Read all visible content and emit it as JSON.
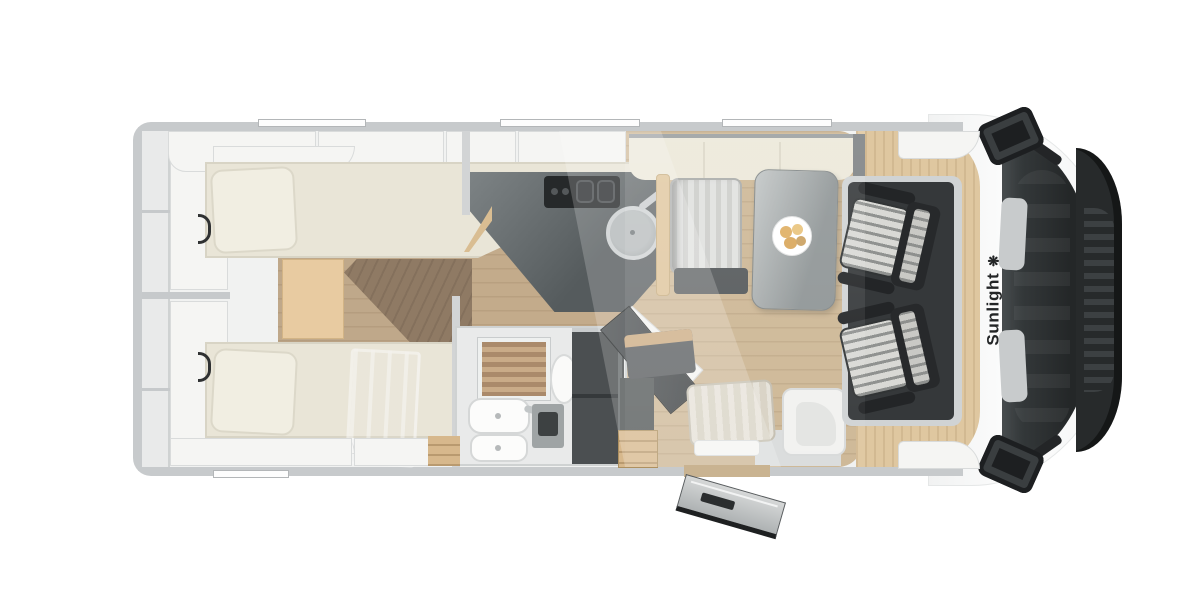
{
  "scene": {
    "description": "Top-down cutaway floor plan rendering of a Sunlight motorhome, front of vehicle facing right"
  },
  "brand": {
    "name": "Sunlight",
    "logo_glyph": "❋"
  },
  "colors": {
    "background": "#ffffff",
    "body_wall": "#c7cacc",
    "interior_floor": "#f1f2f1",
    "bed_cream": "#e9e5d7",
    "backrest_cream": "#ece8d9",
    "wood_step_light": "#e8cba1",
    "wood_floor_mid": "#c3ab8b",
    "wood_floor_dinette": "#cdb795",
    "wood_cab_floor": "#dfc7a0",
    "walkway_dark_wood": "#8f7a64",
    "kitchen_counter": "#62686a",
    "stove": "#26292a",
    "wardrobe": "#4b4f51",
    "cab_floor": "#35383a",
    "windshield": "#272a2b",
    "seat_stripe_light": "#d9d9d5",
    "seat_stripe_dark": "#909290",
    "shower_wood": "#aa8a6b"
  },
  "areas": [
    "rear-storage-shelves",
    "twin-single-beds",
    "center-steps-walkway",
    "kitchen-with-stove-and-sink",
    "bathroom-with-shower-and-toilet",
    "wardrobe",
    "dinette-with-table-and-plate",
    "entry-door-open",
    "swivel-cab-seats",
    "cab-windshield-and-mirrors"
  ],
  "windows": {
    "top_wall_slots": 3,
    "bottom_wall_slots": 1
  }
}
